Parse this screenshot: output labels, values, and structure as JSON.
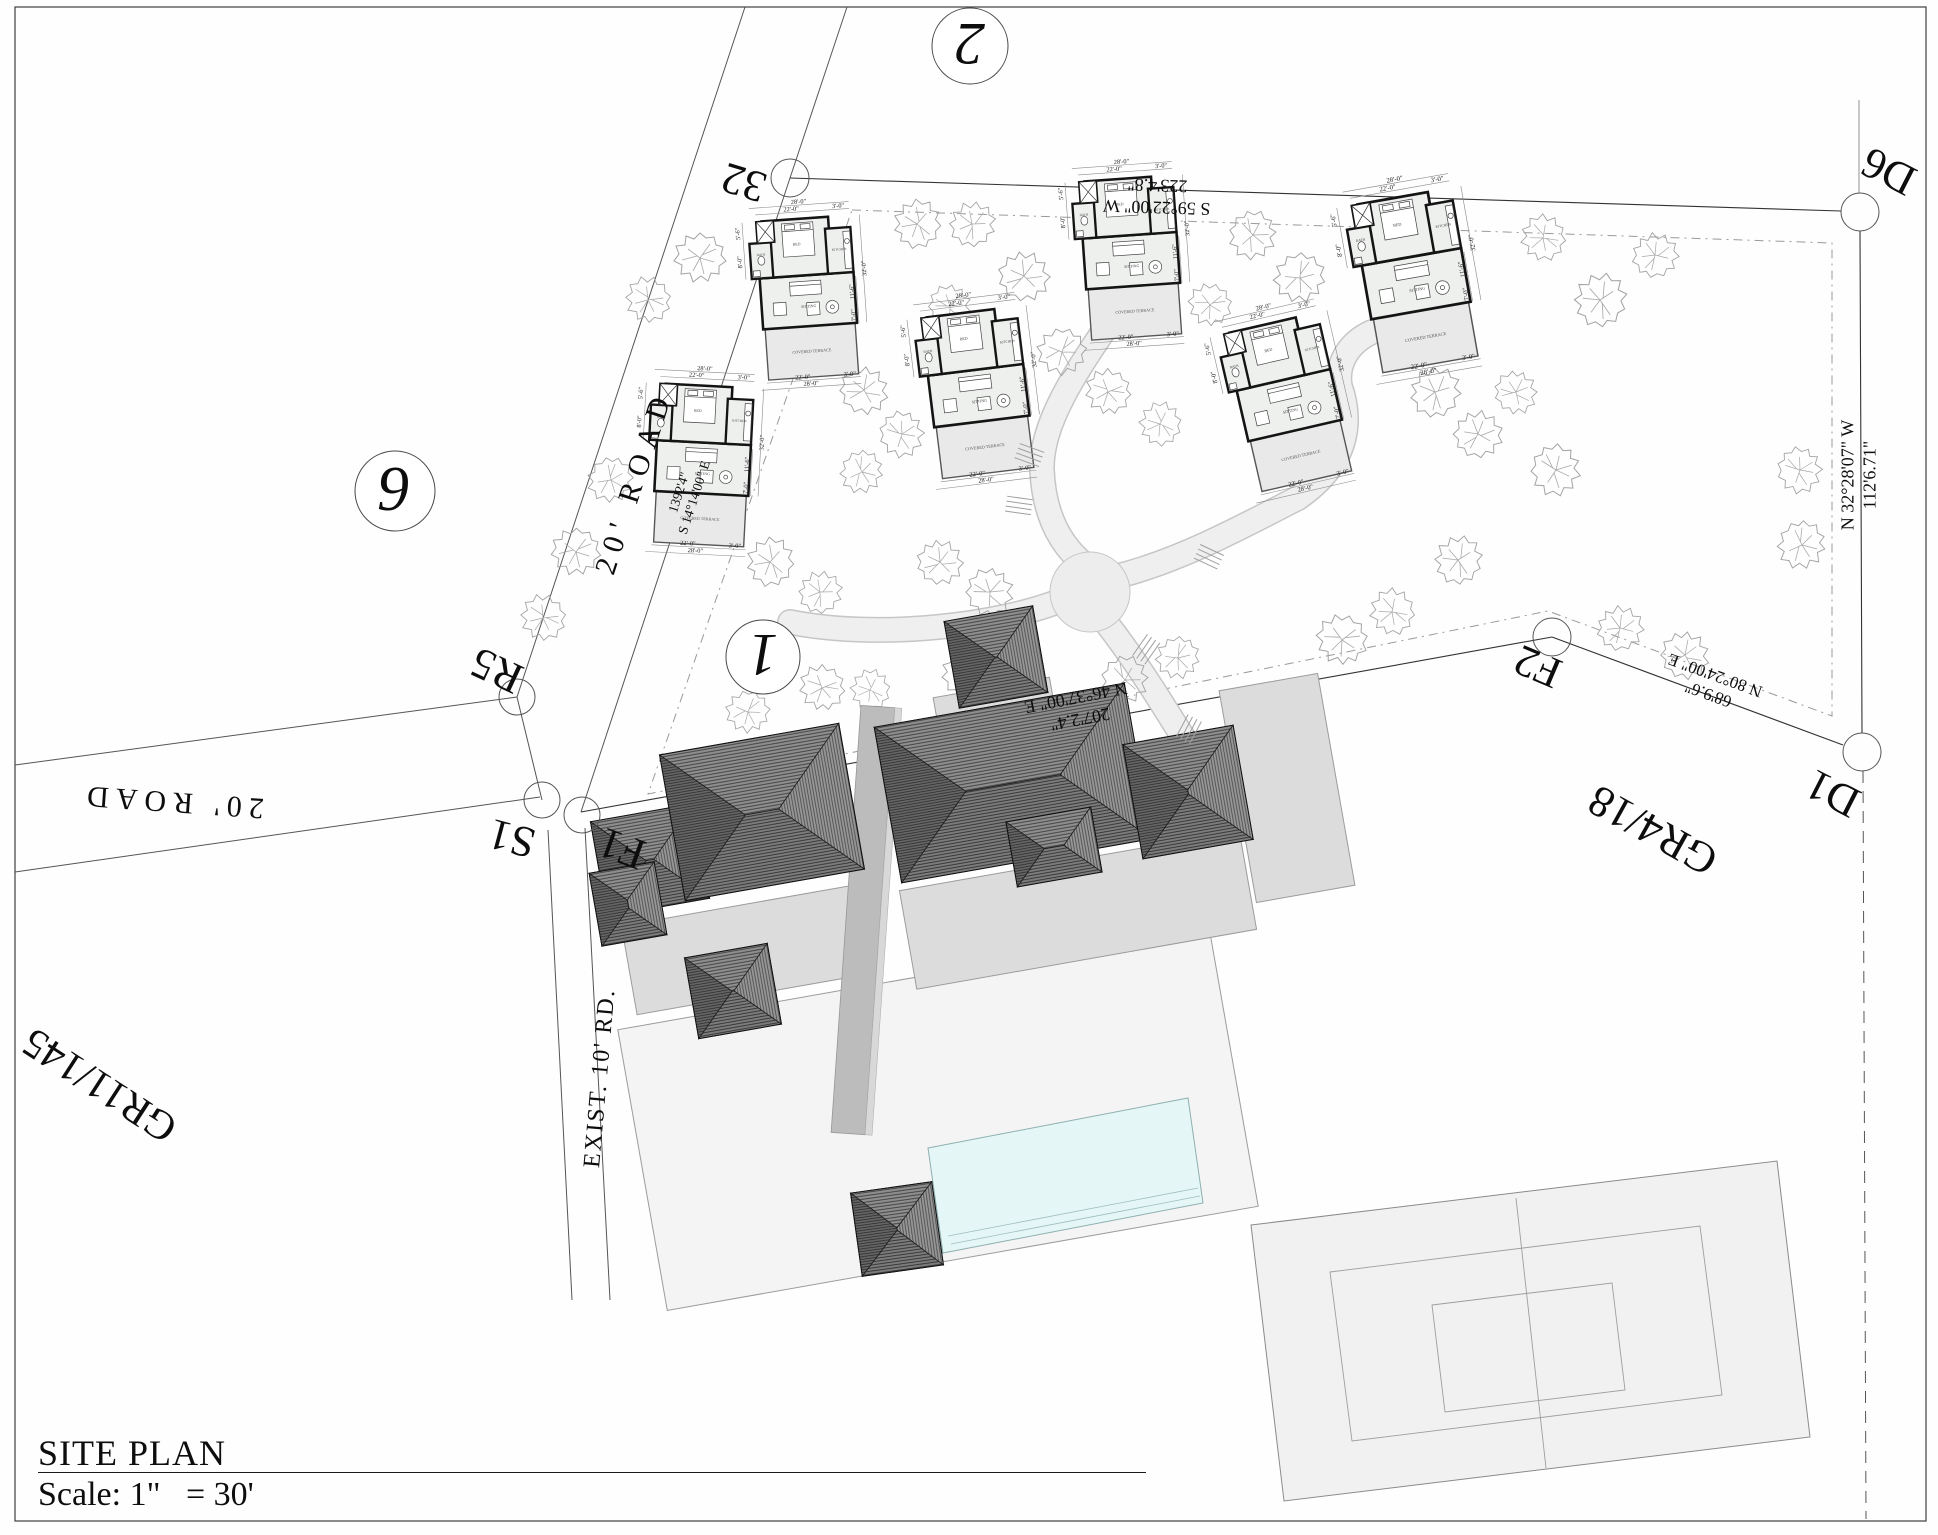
{
  "page": {
    "title": "SITE PLAN",
    "scale": "Scale: 1\"   = 30'"
  },
  "roads": {
    "nw": "20' ROAD",
    "west": "20' ROAD",
    "exist": "EXIST. 10' RD."
  },
  "parcels": {
    "plot_top": "2",
    "plot_left": "9",
    "plot_site": "1",
    "gr_left": "GR11/145",
    "gr_right": "GR4/18"
  },
  "points": {
    "p32": "32",
    "r5": "R5",
    "s1": "S1",
    "f1": "F1",
    "f2": "F2",
    "d1": "D1",
    "d6": "D6"
  },
  "bearings": {
    "north": {
      "bearing": "S 59°22'00\" W",
      "distance": "223'4.8\""
    },
    "road": {
      "distance": "1392'4\"",
      "bearing": "S 14°14'00\" E"
    },
    "south": {
      "distance": "207'2.4\"",
      "bearing": "N 46°37'00\" E"
    },
    "southeast": {
      "distance": "68'9.6\"",
      "bearing": "N 80°24'00\" E"
    },
    "east": {
      "bearing": "N 32°28'07\" W",
      "distance": "112'6.71\""
    }
  },
  "cottage": {
    "rooms": {
      "bed": "BED",
      "bath": "BATH",
      "kitchen": "KITCHEN",
      "sitting": "SITTING",
      "terrace": "COVERED TERRACE"
    },
    "dims": {
      "overall_w": "28'-0\"",
      "main_w": "22'-0\"",
      "wing": "3'-0\"",
      "overall_d": "32'-0\"",
      "seg_a": "5'-6\"",
      "seg_b": "8'-0\"",
      "seg_c": "11'-6\"",
      "seg_d": "7'-0\""
    }
  },
  "colors": {
    "pool": "#e4f6f6",
    "roof": "#7c7c7c",
    "terrace": "#dcdcdc",
    "court": "#f1f1f1"
  }
}
